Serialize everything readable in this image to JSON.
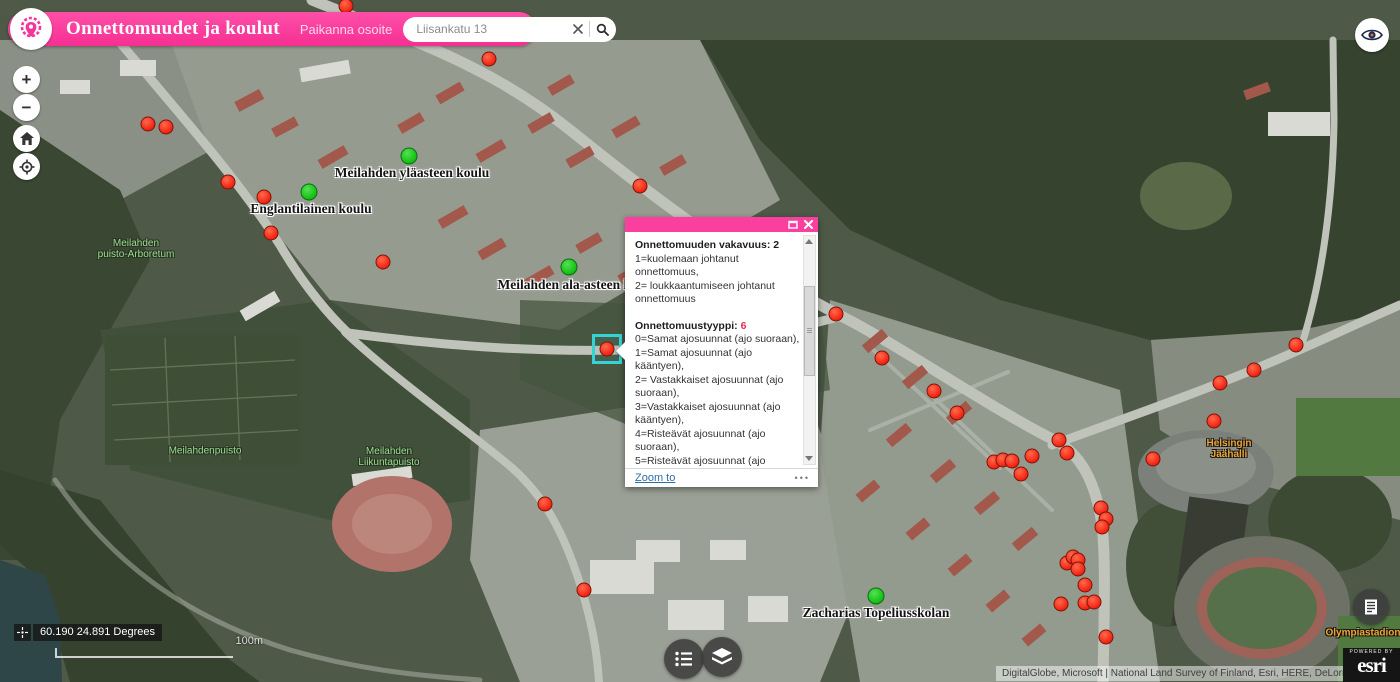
{
  "colors": {
    "accent": "#fb3f9f",
    "accident_red": "#f52a18",
    "school_green": "#17c517",
    "selection_cyan": "#35d3d6",
    "type_value_red": "#e62a52"
  },
  "header": {
    "title": "Onnettomuudet ja koulut",
    "locate_label": "Paikanna osoite",
    "search": {
      "value": "Liisankatu 13"
    }
  },
  "map_controls": {
    "zoom_in": "+",
    "zoom_out": "−"
  },
  "popup": {
    "sections": [
      {
        "title": "Onnettomuuden vakavuus:",
        "value": "2",
        "value_color": "#1d1d1d",
        "lines": [
          "1=kuolemaan johtanut onnettomuus,",
          "2= loukkaantumiseen johtanut onnettomuus"
        ]
      },
      {
        "title": "Onnettomuustyyppi:",
        "value": "6",
        "value_color": "#e62a52",
        "lines": [
          "0=Samat ajosuunnat (ajo suoraan),",
          "1=Samat ajosuunnat (ajo kääntyen),",
          "2= Vastakkaiset ajosuunnat (ajo suoraan),",
          "3=Vastakkaiset ajosuunnat (ajo kääntyen),",
          "4=Risteävät ajosuunnat (ajo suoraan),",
          "5=Risteävät ajosuunnat (ajo kääntyen),",
          "6=Jalankulkijaonnettomuus (suojatiellä)"
        ]
      }
    ],
    "zoom_to": "Zoom to",
    "more": "•••"
  },
  "map": {
    "selected_accident": {
      "x": 607,
      "y": 349
    },
    "accidents": [
      [
        346,
        6
      ],
      [
        489,
        59
      ],
      [
        148,
        124
      ],
      [
        166,
        127
      ],
      [
        228,
        182
      ],
      [
        264,
        197
      ],
      [
        271,
        233
      ],
      [
        383,
        262
      ],
      [
        640,
        186
      ],
      [
        836,
        314
      ],
      [
        882,
        358
      ],
      [
        934,
        391
      ],
      [
        957,
        413
      ],
      [
        994,
        462
      ],
      [
        1003,
        460
      ],
      [
        1012,
        461
      ],
      [
        1021,
        474
      ],
      [
        1032,
        456
      ],
      [
        1059,
        440
      ],
      [
        1067,
        453
      ],
      [
        1101,
        508
      ],
      [
        1106,
        519
      ],
      [
        1102,
        527
      ],
      [
        1067,
        563
      ],
      [
        1073,
        557
      ],
      [
        1078,
        560
      ],
      [
        1078,
        569
      ],
      [
        1061,
        604
      ],
      [
        1085,
        585
      ],
      [
        1085,
        603
      ],
      [
        1094,
        602
      ],
      [
        1106,
        637
      ],
      [
        1153,
        459
      ],
      [
        1214,
        421
      ],
      [
        1220,
        383
      ],
      [
        1254,
        370
      ],
      [
        1296,
        345
      ],
      [
        545,
        504
      ],
      [
        584,
        590
      ]
    ],
    "schools": [
      [
        409,
        156
      ],
      [
        309,
        192
      ],
      [
        569,
        267
      ],
      [
        876,
        596
      ]
    ],
    "school_labels": [
      {
        "text": "Meilahden yläasteen koulu",
        "x": 412,
        "y": 173
      },
      {
        "text": "Englantilainen koulu",
        "x": 311,
        "y": 209
      },
      {
        "text": "Meilahden ala-asteen koulu",
        "x": 577,
        "y": 285
      },
      {
        "text": "Zacharias Topeliusskolan",
        "x": 876,
        "y": 613
      }
    ],
    "park_labels": [
      {
        "lines": [
          "Meilahden",
          "puisto-Arboretum"
        ],
        "x": 136,
        "y": 249
      },
      {
        "lines": [
          "Meilahdenpuisto"
        ],
        "x": 205,
        "y": 451
      },
      {
        "lines": [
          "Meilahden",
          "Liikuntapuisto"
        ],
        "x": 389,
        "y": 457
      }
    ],
    "poi_labels": [
      {
        "lines": [
          "Helsingin",
          "Jäähalli"
        ],
        "x": 1229,
        "y": 449
      },
      {
        "lines": [
          "Olympiastadion"
        ],
        "x": 1363,
        "y": 633
      }
    ]
  },
  "statusbar": {
    "coordinates": "60.190 24.891 Degrees",
    "scale_label": "100m"
  },
  "bottom": {
    "attribution": "DigitalGlobe, Microsoft | National Land Survey of Finland, Esri, HERE, DeLorme, IPC",
    "powered_by": "POWERED BY",
    "brand": "esri"
  }
}
